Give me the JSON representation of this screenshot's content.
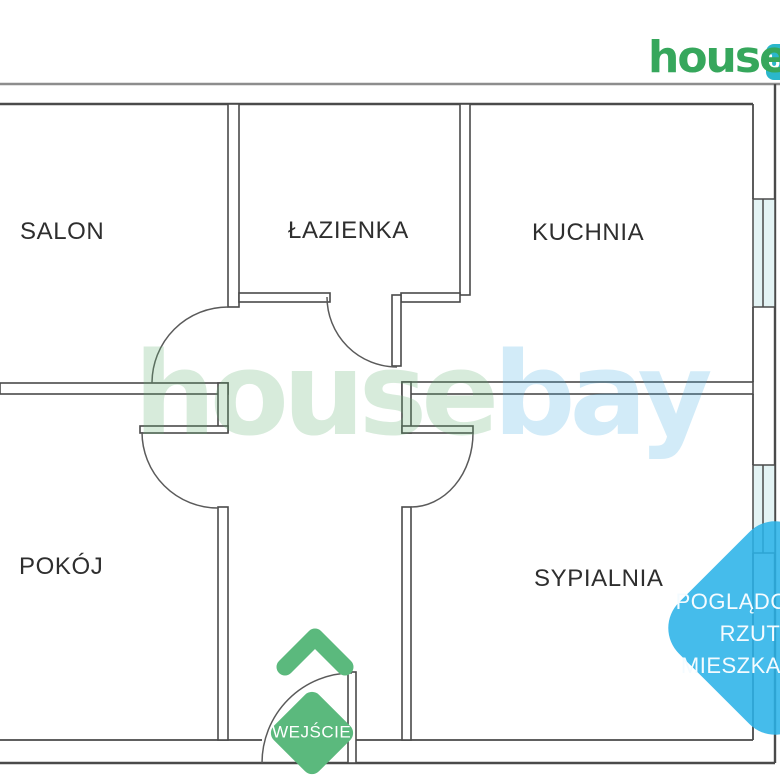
{
  "brand": {
    "logo_text": "house",
    "logo_badge_text": "bay",
    "logo_green": "#36a75c",
    "logo_badge_teal": "#2bb7cb"
  },
  "watermark": {
    "part1": "house",
    "part2": "bay",
    "green_tint": "rgba(96,176,112,0.25)",
    "blue_tint": "rgba(75,175,227,0.25)"
  },
  "rooms": {
    "salon": {
      "label": "SALON"
    },
    "lazienka": {
      "label": "ŁAZIENKA"
    },
    "kuchnia": {
      "label": "KUCHNIA"
    },
    "pokoj": {
      "label": "POKÓJ"
    },
    "sypialnia": {
      "label": "SYPIALNIA"
    }
  },
  "entrance": {
    "label": "WEJŚCIE",
    "arrow_color": "#5bb97d",
    "badge_color": "#5bb97d"
  },
  "corner_note": {
    "lines": [
      "POGLĄDOWY",
      "RZUT",
      "MIESZKANIA"
    ],
    "background": "#29b2e8",
    "text_color": "#ffffff"
  },
  "plan": {
    "wall_color": "#4a4a4a",
    "outer_line_color": "#8d8d8d",
    "window_fill": "#e3f3f4"
  }
}
